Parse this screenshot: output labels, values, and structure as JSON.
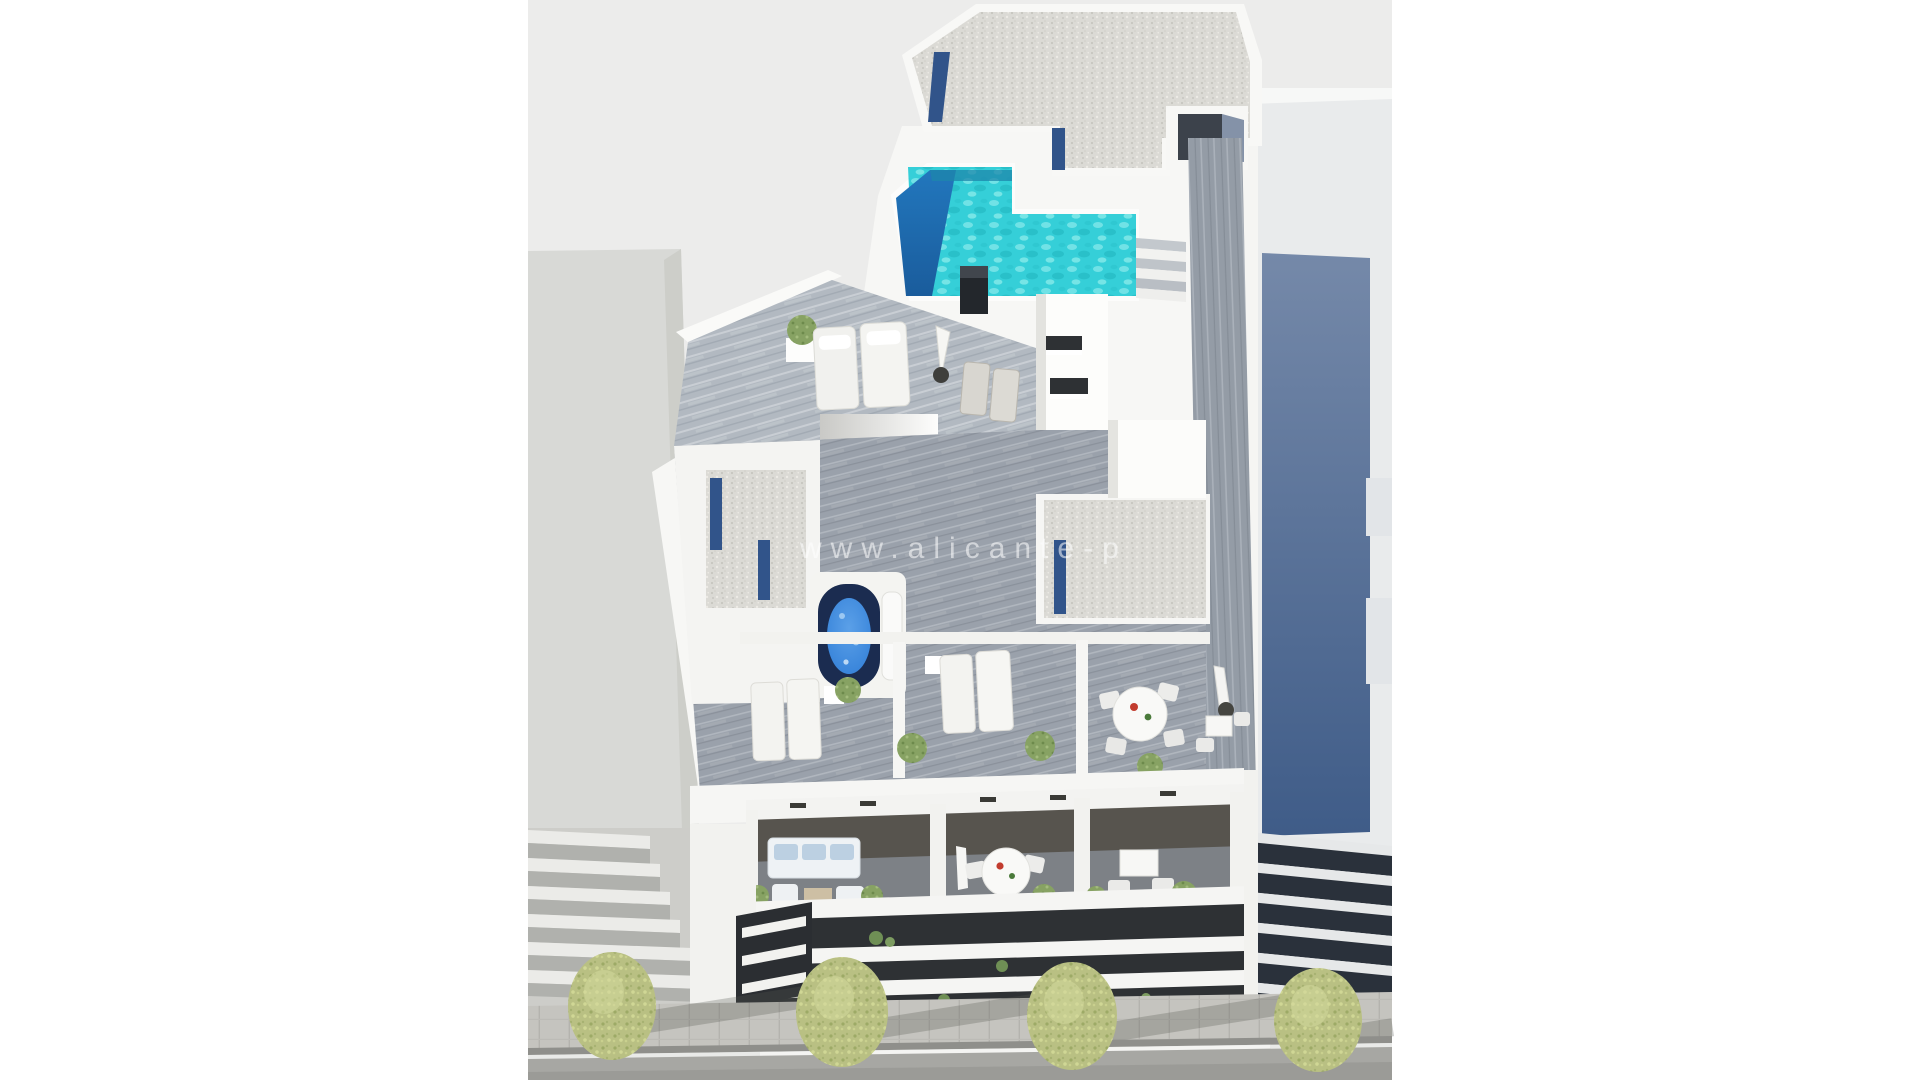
{
  "watermark": {
    "text": "www.alicante-p"
  },
  "colors": {
    "page_bg": "#ffffff",
    "canvas_bg": "#ececeb",
    "white_wall": "#f7f7f5",
    "left_building": "#d8d9d6",
    "left_building_facet": "#cdcec9",
    "left_stripe_dark": "#b0b1ad",
    "left_stripe_light": "#ebebe8",
    "right_building": "#e9ebec",
    "glass_panel_top": "#7589a9",
    "glass_panel_bottom": "#3f5c88",
    "right_stripe_dark": "#2a313b",
    "right_stripe_light": "#e6e8e9",
    "gravel": "#dbdad5",
    "glass_strip": "#31548a",
    "pool_water": "#35cfd8",
    "pool_deep": "#1b63a8",
    "wood_light": "#b2b9c1",
    "wood_mid": "#9aa1ab",
    "wood_dark": "#949ca6",
    "dark_opening": "#2e3134",
    "jacuzzi_shell": "#1b2c50",
    "jacuzzi_water": "#2e7cd6",
    "tree_foliage": "#b9c083",
    "bush_green": "#87a263",
    "sidewalk": "#c5c4bf",
    "road": "#a7a7a3",
    "curb_white": "#e9eae8",
    "accent_red": "#c23c2e"
  }
}
